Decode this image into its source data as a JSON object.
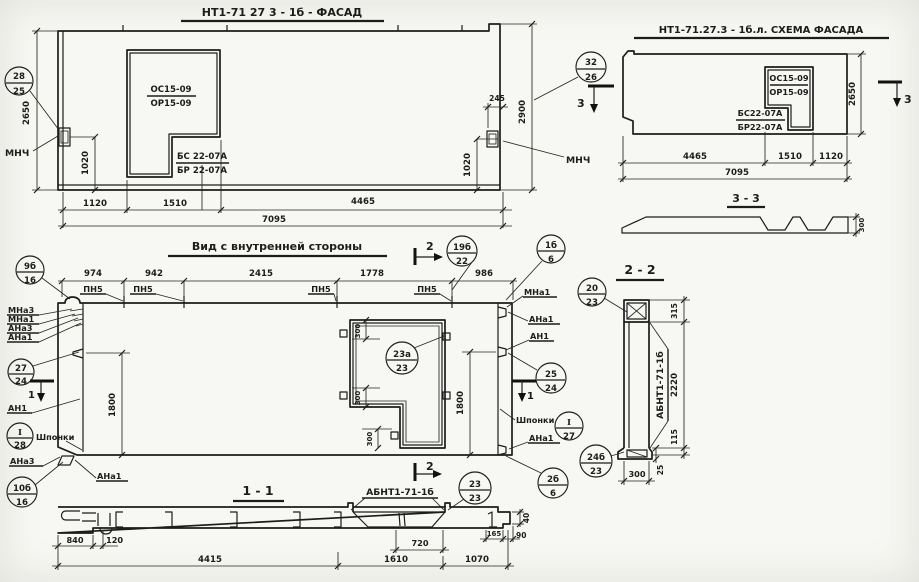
{
  "facade": {
    "title": "НТ1-71 27 3 - 1б - ФАСАД",
    "win_top_num": "ОС15-09",
    "win_top_den": "ОР15-09",
    "win_bot_num": "БС 22-07А",
    "win_bot_den": "БР 22-07А",
    "dim_h": "2650",
    "dim_1020l": "1020",
    "dim_245": "245",
    "dim_1020r": "1020",
    "dim_2900": "2900",
    "dim_b1": "1120",
    "dim_b2": "1510",
    "dim_b3": "4465",
    "dim_total": "7095",
    "mnch_l": "МНЧ",
    "mnch_r": "МНЧ",
    "sec3": "3"
  },
  "schema": {
    "title": "НТ1-71.27.3 - 1б.л. СХЕМА ФАСАДА",
    "win_top_num": "ОС15-09",
    "win_top_den": "ОР15-09",
    "win_bot_num": "БС22-07А",
    "win_bot_den": "БР22-07А",
    "dim_h": "2650",
    "dim_b1": "4465",
    "dim_b2": "1510",
    "dim_b3": "1120",
    "dim_total": "7095",
    "sec3": "3",
    "s33_title": "3 - 3",
    "s33_dim": "300"
  },
  "inner": {
    "title": "Вид с внутренней стороны",
    "dims_top": [
      "974",
      "942",
      "2415",
      "1778",
      "986"
    ],
    "pn5": "ПН5",
    "dim_1800l": "1800",
    "dim_1800r": "1800",
    "dim_300a": "300",
    "dim_300b": "300",
    "dim_300c": "300",
    "lbl": {
      "mna3": "МНа3",
      "mna1": "МНа1",
      "ana3": "АНа3",
      "ana1": "АНа1",
      "an1": "АН1",
      "shponki": "Шпонки"
    },
    "sec1": "1",
    "sec2": "2"
  },
  "s11": {
    "title": "1 - 1",
    "abnt": "АБНТ1-71-1б",
    "dims": {
      "d840": "840",
      "d120": "120",
      "d4415": "4415",
      "d720": "720",
      "d1610": "1610",
      "d1070": "1070",
      "d165": "165",
      "d90": "90",
      "d40": "40"
    }
  },
  "s22": {
    "title": "2 - 2",
    "abnt": "АБНТ1-71-1б",
    "dims": {
      "d315": "315",
      "d2220": "2220",
      "d115": "115",
      "d25": "25",
      "d300": "300"
    }
  },
  "callouts": {
    "c28_25": {
      "t": "28",
      "b": "25"
    },
    "c32_26": {
      "t": "32",
      "b": "26"
    },
    "c9b_16": {
      "t": "9б",
      "b": "16"
    },
    "c19b_22": {
      "t": "19б",
      "b": "22"
    },
    "c1b_6": {
      "t": "1б",
      "b": "6"
    },
    "c27_24": {
      "t": "27",
      "b": "24"
    },
    "c25_24": {
      "t": "25",
      "b": "24"
    },
    "cI_28": {
      "t": "I",
      "b": "28"
    },
    "cI_27": {
      "t": "I",
      "b": "27"
    },
    "c23a_23": {
      "t": "23а",
      "b": "23"
    },
    "c10b_16": {
      "t": "10б",
      "b": "16"
    },
    "c2b_6": {
      "t": "2б",
      "b": "6"
    },
    "c23_23": {
      "t": "23",
      "b": "23"
    },
    "c24b_23": {
      "t": "24б",
      "b": "23"
    },
    "c20_23": {
      "t": "20",
      "b": "23"
    }
  }
}
